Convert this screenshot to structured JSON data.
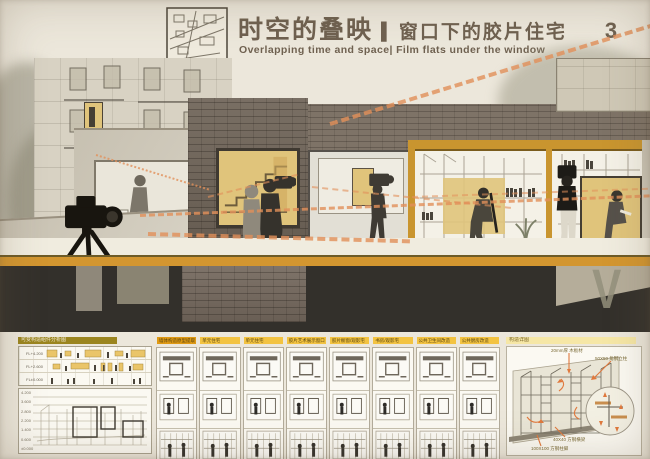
{
  "header": {
    "title_main": "时空的叠映",
    "title_divider": "|",
    "title_sub": "窗口下的胶片住宅",
    "sheet_number": "3",
    "subtitle_en": "Overlapping time and space| Film flats  under the window"
  },
  "palette": {
    "paper": "#ece7db",
    "accent_orange": "#e2905a",
    "gold_window": "#e0c47b",
    "ochre_frame": "#c9952f",
    "brick": "#6f6458",
    "foundation": "#33302b",
    "header_olive": "#9b851f",
    "header_yellow": "#f3c341",
    "header_orange": "#e09a14",
    "title_brown": "#6f6150"
  },
  "bottom_strip": {
    "left_panel": {
      "header": "可变构造组件分析图",
      "row_labels": [
        "FL+4.200",
        "FL+2.600",
        "FL±0.000"
      ],
      "levels": [
        "4.200",
        "3.600",
        "2.800",
        "2.200",
        "1.400",
        "0.600",
        "±0.000"
      ]
    },
    "columns": [
      {
        "label": "墙体构造原型提取",
        "tone": "dark"
      },
      {
        "label": "单元住宅",
        "tone": "light"
      },
      {
        "label": "单元住宅",
        "tone": "light"
      },
      {
        "label": "胶片艺术展示窗口",
        "tone": "light"
      },
      {
        "label": "胶片橱窗/观影宅",
        "tone": "light"
      },
      {
        "label": "书房/观影宅",
        "tone": "light"
      },
      {
        "label": "公共卫生间改造",
        "tone": "light"
      },
      {
        "label": "公共厨房改造",
        "tone": "light"
      }
    ],
    "right_panel": {
      "header": "构造详图",
      "annotations": [
        "20mm厚 木板材",
        "50X50 角钢立柱",
        "40X40 方钢横梁",
        "100X100 方钢柱脚"
      ]
    }
  }
}
